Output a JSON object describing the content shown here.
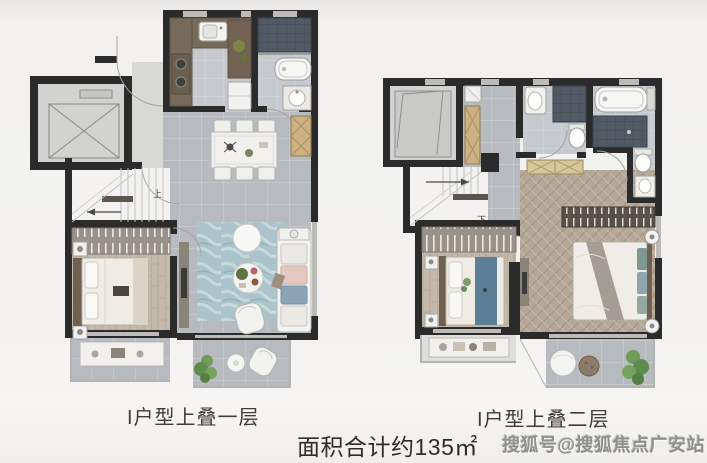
{
  "page": {
    "background": "#f1f0ee"
  },
  "plans": [
    {
      "caption": "I户型上叠一层",
      "stair_label": "上"
    },
    {
      "caption": "I户型上叠二层",
      "stair_label": "下"
    }
  ],
  "footer": {
    "area_text": "面积合计约135㎡",
    "watermark": "搜狐号@搜狐焦点广安站"
  },
  "colors": {
    "wall": "#2b2b2b",
    "floor_tile": "#b7babe",
    "wood_floor": "#c3b9ab",
    "herringbone_floor": "#b5a898",
    "rug": "#abc4cb",
    "dark_tile": "#525a66",
    "cabinet_wood": "#cdb183",
    "caption_text": "#3e3d3b",
    "watermark_text": "#8f8f8b"
  }
}
